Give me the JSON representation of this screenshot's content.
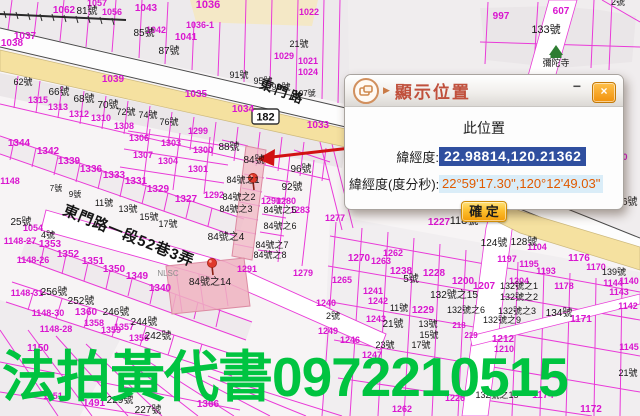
{
  "dialog": {
    "title": "顯示位置",
    "minimize_label": "−",
    "close_label": "×",
    "section_title": "此位置",
    "latlng_label": "緯經度:",
    "latlng_value": "22.98814,120.21362",
    "dms_label": "緯經度(度分秒):",
    "dms_value": "22°59'17.30\",120°12'49.03\"",
    "confirm_label": "確 定"
  },
  "watermark": {
    "text": "法拍黃代書0972210515",
    "color": "#00c440"
  },
  "map": {
    "road_shield": "182",
    "label_colors": {
      "m": "#d916cf",
      "b": "#161616",
      "g": "#8d8d8d"
    },
    "labels": [
      {
        "x": 64,
        "y": 13,
        "t": "1062"
      },
      {
        "x": 97,
        "y": 6,
        "t": "1057",
        "s": 9
      },
      {
        "x": 112,
        "y": 15,
        "t": "1056",
        "s": 9
      },
      {
        "x": 146,
        "y": 11,
        "t": "1043"
      },
      {
        "x": 208,
        "y": 8,
        "t": "1036",
        "s": 11
      },
      {
        "x": 156,
        "y": 33,
        "t": "1042",
        "s": 9
      },
      {
        "x": 186,
        "y": 40,
        "t": "1041"
      },
      {
        "x": 200,
        "y": 28,
        "t": "1036-1",
        "s": 9
      },
      {
        "x": 25,
        "y": 39,
        "t": "1037"
      },
      {
        "x": 12,
        "y": 46,
        "t": "1038"
      },
      {
        "x": 113,
        "y": 82,
        "t": "1039"
      },
      {
        "x": 196,
        "y": 97,
        "t": "1035"
      },
      {
        "x": 243,
        "y": 112,
        "t": "1034"
      },
      {
        "x": 318,
        "y": 128,
        "t": "1033"
      },
      {
        "x": 309,
        "y": 15,
        "t": "1022",
        "s": 9
      },
      {
        "x": 561,
        "y": 14,
        "t": "607"
      },
      {
        "x": 501,
        "y": 19,
        "t": "997"
      },
      {
        "x": 284,
        "y": 59,
        "t": "1029",
        "s": 9
      },
      {
        "x": 308,
        "y": 64,
        "t": "1021",
        "s": 9
      },
      {
        "x": 308,
        "y": 75,
        "t": "1024",
        "s": 9
      },
      {
        "x": 620,
        "y": 160,
        "t": "400",
        "s": 9
      },
      {
        "x": 58,
        "y": 110,
        "t": "1313",
        "s": 9
      },
      {
        "x": 79,
        "y": 117,
        "t": "1312",
        "s": 9
      },
      {
        "x": 101,
        "y": 121,
        "t": "1310",
        "s": 9
      },
      {
        "x": 124,
        "y": 129,
        "t": "1308",
        "s": 9
      },
      {
        "x": 38,
        "y": 103,
        "t": "1315",
        "s": 9
      },
      {
        "x": 19,
        "y": 146,
        "t": "1344"
      },
      {
        "x": 48,
        "y": 154,
        "t": "1342"
      },
      {
        "x": 69,
        "y": 164,
        "t": "1339"
      },
      {
        "x": 91,
        "y": 172,
        "t": "1336"
      },
      {
        "x": 114,
        "y": 178,
        "t": "1333"
      },
      {
        "x": 136,
        "y": 184,
        "t": "1331"
      },
      {
        "x": 158,
        "y": 192,
        "t": "1329"
      },
      {
        "x": 186,
        "y": 202,
        "t": "1327"
      },
      {
        "x": 139,
        "y": 141,
        "t": "1306",
        "s": 9
      },
      {
        "x": 171,
        "y": 146,
        "t": "1303",
        "s": 9
      },
      {
        "x": 203,
        "y": 153,
        "t": "1300",
        "s": 9
      },
      {
        "x": 143,
        "y": 158,
        "t": "1307",
        "s": 9
      },
      {
        "x": 168,
        "y": 164,
        "t": "1304",
        "s": 9
      },
      {
        "x": 198,
        "y": 172,
        "t": "1301",
        "s": 9
      },
      {
        "x": 198,
        "y": 134,
        "t": "1299",
        "s": 9
      },
      {
        "x": 214,
        "y": 198,
        "t": "1292",
        "s": 9
      },
      {
        "x": 271,
        "y": 204,
        "t": "1290",
        "s": 9
      },
      {
        "x": 286,
        "y": 204,
        "t": "1280",
        "s": 9
      },
      {
        "x": 300,
        "y": 213,
        "t": "1283",
        "s": 9
      },
      {
        "x": 335,
        "y": 221,
        "t": "1277",
        "s": 9
      },
      {
        "x": 247,
        "y": 272,
        "t": "1291",
        "s": 9
      },
      {
        "x": 303,
        "y": 276,
        "t": "1279",
        "s": 9
      },
      {
        "x": 50,
        "y": 247,
        "t": "1353"
      },
      {
        "x": 68,
        "y": 257,
        "t": "1352"
      },
      {
        "x": 93,
        "y": 264,
        "t": "1351"
      },
      {
        "x": 114,
        "y": 272,
        "t": "1350"
      },
      {
        "x": 137,
        "y": 279,
        "t": "1349"
      },
      {
        "x": 160,
        "y": 291,
        "t": "1340"
      },
      {
        "x": 10,
        "y": 184,
        "t": "1148",
        "s": 9
      },
      {
        "x": 33,
        "y": 231,
        "t": "1054",
        "s": 9
      },
      {
        "x": 20,
        "y": 244,
        "t": "1148-27",
        "s": 9
      },
      {
        "x": 33,
        "y": 263,
        "t": "1148-26",
        "s": 9
      },
      {
        "x": 27,
        "y": 296,
        "t": "1148-31",
        "s": 9
      },
      {
        "x": 48,
        "y": 316,
        "t": "1148-30",
        "s": 9
      },
      {
        "x": 56,
        "y": 332,
        "t": "1148-28",
        "s": 9
      },
      {
        "x": 86,
        "y": 315,
        "t": "1360"
      },
      {
        "x": 94,
        "y": 326,
        "t": "1358",
        "s": 9
      },
      {
        "x": 111,
        "y": 333,
        "t": "1359",
        "s": 9
      },
      {
        "x": 124,
        "y": 330,
        "t": "1357",
        "s": 9
      },
      {
        "x": 139,
        "y": 341,
        "t": "1356",
        "s": 9
      },
      {
        "x": 38,
        "y": 351,
        "t": "1150"
      },
      {
        "x": 57,
        "y": 399,
        "t": "1151-1",
        "s": 9
      },
      {
        "x": 94,
        "y": 406,
        "t": "1491"
      },
      {
        "x": 208,
        "y": 407,
        "t": "1366"
      },
      {
        "x": 359,
        "y": 261,
        "t": "1270"
      },
      {
        "x": 381,
        "y": 264,
        "t": "1263",
        "s": 9
      },
      {
        "x": 393,
        "y": 256,
        "t": "1262",
        "s": 9
      },
      {
        "x": 401,
        "y": 274,
        "t": "1238"
      },
      {
        "x": 342,
        "y": 283,
        "t": "1265",
        "s": 9
      },
      {
        "x": 434,
        "y": 276,
        "t": "1228"
      },
      {
        "x": 373,
        "y": 294,
        "t": "1241",
        "s": 9
      },
      {
        "x": 378,
        "y": 304,
        "t": "1242",
        "s": 9
      },
      {
        "x": 423,
        "y": 313,
        "t": "1229"
      },
      {
        "x": 376,
        "y": 322,
        "t": "1243",
        "s": 9
      },
      {
        "x": 350,
        "y": 343,
        "t": "1246",
        "s": 9
      },
      {
        "x": 326,
        "y": 306,
        "t": "1240",
        "s": 9
      },
      {
        "x": 328,
        "y": 334,
        "t": "1249",
        "s": 9
      },
      {
        "x": 372,
        "y": 358,
        "t": "1247",
        "s": 9
      },
      {
        "x": 463,
        "y": 284,
        "t": "1200"
      },
      {
        "x": 484,
        "y": 289,
        "t": "1207"
      },
      {
        "x": 439,
        "y": 225,
        "t": "1227"
      },
      {
        "x": 537,
        "y": 250,
        "t": "1104",
        "s": 9
      },
      {
        "x": 507,
        "y": 262,
        "t": "1197",
        "s": 9
      },
      {
        "x": 529,
        "y": 267,
        "t": "1195",
        "s": 9
      },
      {
        "x": 546,
        "y": 274,
        "t": "1193",
        "s": 9
      },
      {
        "x": 579,
        "y": 261,
        "t": "1176"
      },
      {
        "x": 596,
        "y": 270,
        "t": "1170",
        "s": 9
      },
      {
        "x": 519,
        "y": 284,
        "t": "1204",
        "s": 9
      },
      {
        "x": 564,
        "y": 289,
        "t": "1178",
        "s": 9
      },
      {
        "x": 613,
        "y": 286,
        "t": "1144",
        "s": 9
      },
      {
        "x": 629,
        "y": 284,
        "t": "1140",
        "s": 9
      },
      {
        "x": 619,
        "y": 295,
        "t": "1143",
        "s": 9
      },
      {
        "x": 628,
        "y": 309,
        "t": "1142",
        "s": 9
      },
      {
        "x": 581,
        "y": 322,
        "t": "1171"
      },
      {
        "x": 503,
        "y": 342,
        "t": "1212"
      },
      {
        "x": 504,
        "y": 352,
        "t": "1210",
        "s": 9
      },
      {
        "x": 629,
        "y": 350,
        "t": "1145",
        "s": 9
      },
      {
        "x": 543,
        "y": 398,
        "t": "1174"
      },
      {
        "x": 591,
        "y": 412,
        "t": "1172"
      },
      {
        "x": 455,
        "y": 401,
        "t": "1226",
        "s": 9
      },
      {
        "x": 402,
        "y": 412,
        "t": "1262",
        "s": 9
      },
      {
        "x": 459,
        "y": 328,
        "t": "218",
        "s": 8
      },
      {
        "x": 471,
        "y": 338,
        "t": "219",
        "s": 8
      },
      {
        "x": 87,
        "y": 14,
        "t": "81號",
        "c": "b"
      },
      {
        "x": 144,
        "y": 36,
        "t": "85號",
        "c": "b"
      },
      {
        "x": 169,
        "y": 54,
        "t": "87號",
        "c": "b"
      },
      {
        "x": 239,
        "y": 78,
        "t": "91號",
        "c": "b",
        "s": 9
      },
      {
        "x": 263,
        "y": 84,
        "t": "95號",
        "c": "b",
        "s": 9
      },
      {
        "x": 281,
        "y": 90,
        "t": "99號",
        "c": "b",
        "s": 9
      },
      {
        "x": 305,
        "y": 96,
        "t": "107號",
        "c": "b",
        "s": 8
      },
      {
        "x": 23,
        "y": 85,
        "t": "62號",
        "c": "b",
        "s": 9
      },
      {
        "x": 59,
        "y": 95,
        "t": "66號",
        "c": "b"
      },
      {
        "x": 84,
        "y": 102,
        "t": "68號",
        "c": "b"
      },
      {
        "x": 108,
        "y": 108,
        "t": "70號",
        "c": "b"
      },
      {
        "x": 126,
        "y": 115,
        "t": "72號",
        "c": "b",
        "s": 9
      },
      {
        "x": 148,
        "y": 118,
        "t": "74號",
        "c": "b",
        "s": 9
      },
      {
        "x": 169,
        "y": 125,
        "t": "76號",
        "c": "b",
        "s": 9
      },
      {
        "x": 618,
        "y": 5,
        "t": "2號",
        "c": "b",
        "s": 9
      },
      {
        "x": 546,
        "y": 33,
        "t": "133號",
        "c": "b",
        "s": 11
      },
      {
        "x": 299,
        "y": 47,
        "t": "21號",
        "c": "b",
        "s": 9
      },
      {
        "x": 229,
        "y": 150,
        "t": "88號",
        "c": "b"
      },
      {
        "x": 254,
        "y": 163,
        "t": "84號",
        "c": "b"
      },
      {
        "x": 301,
        "y": 172,
        "t": "96號",
        "c": "b"
      },
      {
        "x": 292,
        "y": 190,
        "t": "92號",
        "c": "b"
      },
      {
        "x": 243,
        "y": 183,
        "t": "84號之1",
        "c": "b",
        "s": 9
      },
      {
        "x": 239,
        "y": 200,
        "t": "84號之2",
        "c": "b",
        "s": 9
      },
      {
        "x": 236,
        "y": 212,
        "t": "84號之3",
        "c": "b",
        "s": 9
      },
      {
        "x": 280,
        "y": 213,
        "t": "84號之5",
        "c": "b",
        "s": 9
      },
      {
        "x": 280,
        "y": 229,
        "t": "84號之6",
        "c": "b",
        "s": 9
      },
      {
        "x": 226,
        "y": 240,
        "t": "84號之4",
        "c": "b"
      },
      {
        "x": 272,
        "y": 248,
        "t": "84號之7",
        "c": "b",
        "s": 9
      },
      {
        "x": 270,
        "y": 258,
        "t": "84號之8",
        "c": "b",
        "s": 9
      },
      {
        "x": 210,
        "y": 285,
        "t": "84號之14",
        "c": "b"
      },
      {
        "x": 21,
        "y": 225,
        "t": "25號",
        "c": "b"
      },
      {
        "x": 48,
        "y": 238,
        "t": "4號",
        "c": "b",
        "s": 9
      },
      {
        "x": 56,
        "y": 191,
        "t": "7號",
        "c": "b",
        "s": 8
      },
      {
        "x": 75,
        "y": 197,
        "t": "9號",
        "c": "b",
        "s": 8
      },
      {
        "x": 104,
        "y": 206,
        "t": "11號",
        "c": "b",
        "s": 9
      },
      {
        "x": 128,
        "y": 212,
        "t": "13號",
        "c": "b",
        "s": 9
      },
      {
        "x": 149,
        "y": 220,
        "t": "15號",
        "c": "b",
        "s": 9
      },
      {
        "x": 168,
        "y": 227,
        "t": "17號",
        "c": "b",
        "s": 9
      },
      {
        "x": 411,
        "y": 282,
        "t": "5號",
        "c": "b"
      },
      {
        "x": 399,
        "y": 311,
        "t": "11號",
        "c": "b",
        "s": 9
      },
      {
        "x": 393,
        "y": 327,
        "t": "21號",
        "c": "b"
      },
      {
        "x": 428,
        "y": 327,
        "t": "13號",
        "c": "b",
        "s": 9
      },
      {
        "x": 429,
        "y": 338,
        "t": "15號",
        "c": "b",
        "s": 9
      },
      {
        "x": 421,
        "y": 348,
        "t": "17號",
        "c": "b",
        "s": 9
      },
      {
        "x": 385,
        "y": 348,
        "t": "23號",
        "c": "b",
        "s": 9
      },
      {
        "x": 333,
        "y": 319,
        "t": "2號",
        "c": "b",
        "s": 9
      },
      {
        "x": 464,
        "y": 224,
        "t": "118號",
        "c": "b",
        "s": 11
      },
      {
        "x": 494,
        "y": 246,
        "t": "124號",
        "c": "b"
      },
      {
        "x": 524,
        "y": 245,
        "t": "128號",
        "c": "b"
      },
      {
        "x": 627,
        "y": 205,
        "t": "46號",
        "c": "b"
      },
      {
        "x": 614,
        "y": 275,
        "t": "139號",
        "c": "b",
        "s": 9
      },
      {
        "x": 559,
        "y": 316,
        "t": "134號",
        "c": "b"
      },
      {
        "x": 454,
        "y": 298,
        "t": "132號之15",
        "c": "b"
      },
      {
        "x": 466,
        "y": 313,
        "t": "132號之6",
        "c": "b",
        "s": 9
      },
      {
        "x": 519,
        "y": 289,
        "t": "132號之1",
        "c": "b",
        "s": 9
      },
      {
        "x": 519,
        "y": 300,
        "t": "132號之2",
        "c": "b",
        "s": 9
      },
      {
        "x": 517,
        "y": 314,
        "t": "132號之3",
        "c": "b",
        "s": 9
      },
      {
        "x": 502,
        "y": 323,
        "t": "132號之9",
        "c": "b",
        "s": 9
      },
      {
        "x": 497,
        "y": 398,
        "t": "132號之15",
        "c": "b",
        "s": 9
      },
      {
        "x": 628,
        "y": 376,
        "t": "21號",
        "c": "b",
        "s": 9
      },
      {
        "x": 54,
        "y": 295,
        "t": "256號",
        "c": "b"
      },
      {
        "x": 81,
        "y": 304,
        "t": "252號",
        "c": "b"
      },
      {
        "x": 116,
        "y": 315,
        "t": "246號",
        "c": "b"
      },
      {
        "x": 144,
        "y": 325,
        "t": "244號",
        "c": "b"
      },
      {
        "x": 158,
        "y": 339,
        "t": "242號",
        "c": "b"
      },
      {
        "x": 120,
        "y": 403,
        "t": "229號",
        "c": "b"
      },
      {
        "x": 148,
        "y": 413,
        "t": "227號",
        "c": "b"
      },
      {
        "x": 556,
        "y": 66,
        "t": "彌陀寺",
        "c": "b",
        "s": 9
      },
      {
        "x": 281,
        "y": 96,
        "t": "東門路",
        "c": "b",
        "s": 13,
        "r": 21,
        "w": "b",
        "ls": 3
      },
      {
        "x": 62,
        "y": 214,
        "t": "東門路一段52巷3弄",
        "c": "b",
        "s": 15,
        "r": 22,
        "w": "b",
        "a": "s",
        "ls": 1
      },
      {
        "x": 168,
        "y": 276,
        "t": "NLSC",
        "c": "g",
        "s": 8
      }
    ]
  }
}
